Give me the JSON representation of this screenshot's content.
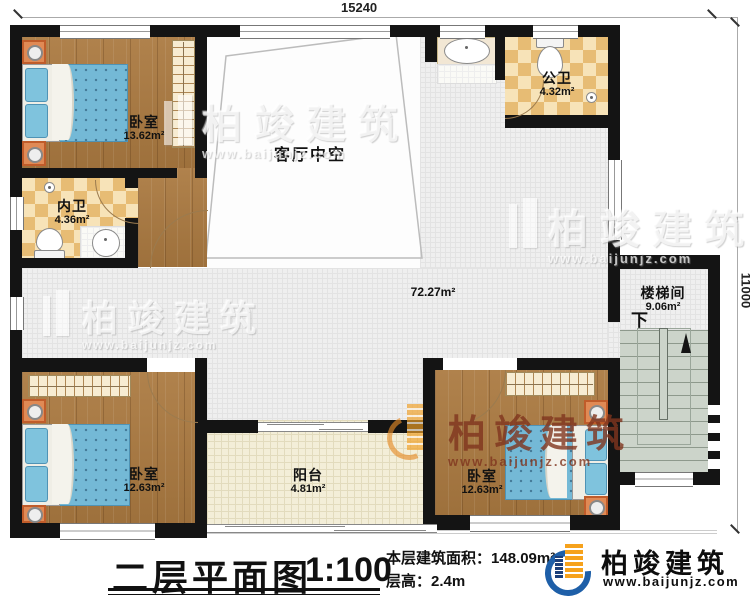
{
  "plan": {
    "dim_top": "15240",
    "dim_right": "11000",
    "hall_area": "72.27m²",
    "rooms": {
      "bedroom1": {
        "name": "卧室",
        "area": "13.62m²"
      },
      "bathroom_private": {
        "name": "内卫",
        "area": "4.36m²"
      },
      "bathroom_public": {
        "name": "公卫",
        "area": "4.32m²"
      },
      "living_void": {
        "name": "客厅中空"
      },
      "stairwell": {
        "name": "楼梯间",
        "area": "9.06m²",
        "down_label": "下"
      },
      "bedroom2": {
        "name": "卧室",
        "area": "12.63m²"
      },
      "bedroom3": {
        "name": "卧室",
        "area": "12.63m²"
      },
      "balcony": {
        "name": "阳台",
        "area": "4.81m²"
      }
    }
  },
  "title_block": {
    "title": "二层平面图",
    "scale": "1:100",
    "area_label": "本层建筑面积：",
    "area_value": "148.09m²",
    "floor_height_label": "层高：",
    "floor_height_value": "2.4m"
  },
  "brand": {
    "name": "柏竣建筑",
    "website": "www.baijunjz.com"
  },
  "colors": {
    "wall": "#141414",
    "wood": "#ab7a41",
    "tile": "#efefef",
    "checker": "#e7bc74",
    "balcony_floor": "#f3eed8",
    "stairs": "#ccd4ca",
    "bed": "#74b9d6",
    "brand_orange": "#f6a21c",
    "brand_blue": "#1e5fa8"
  }
}
